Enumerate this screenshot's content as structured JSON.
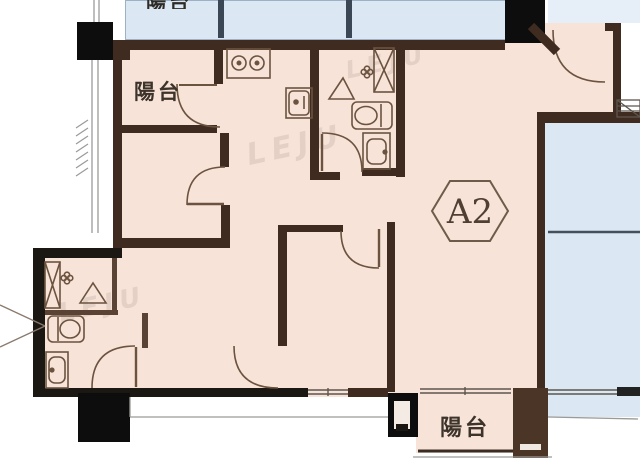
{
  "plan": {
    "unit_label": "A2",
    "labels": {
      "balcony_top": "陽台",
      "balcony_bottom": "陽台",
      "neighbor_balcony_partial": "陽台"
    },
    "watermark": "LEJU",
    "colors": {
      "floor_fill": "#f8e3d8",
      "neighbor_fill": "#dbe7f3",
      "wall_brown": "#3f2b20",
      "wall_black": "#1b1713",
      "column_black": "#0d0d0d",
      "fixture_line": "#6b5340",
      "label_text": "#3c332a"
    },
    "icons": {
      "stove": "two-burner cooktop, kitchen top wall",
      "kitchen_sink": "square sink with faucet dot, kitchen right wall",
      "toilet_top_bathroom": "toilet against right wall of upper bathroom",
      "basin_top_bathroom": "wash basin below toilet, upper bathroom",
      "shower_top_bathroom": "corner shower triangle, upper bathroom",
      "drain_top_bathroom": "floor drain flower, upper bathroom",
      "shaft_top_bathroom": "hatched duct shaft, upper bathroom",
      "toilet_lower_bathroom": "toilet against left wall of lower bathroom",
      "basin_lower_bathroom": "wash basin, lower bathroom",
      "shower_lower_bathroom": "corner shower triangle, lower bathroom",
      "drain_lower_bathroom": "floor drain flower, lower bathroom",
      "shaft_lower_bathroom": "hatched duct shaft, lower bathroom",
      "entry_door": "arc top right",
      "doors": "quarter-circle swing arcs at each room opening",
      "windows": "double-line sliding windows on bottom walls",
      "stair_hatch": "hatched block outside right entry wall"
    }
  }
}
